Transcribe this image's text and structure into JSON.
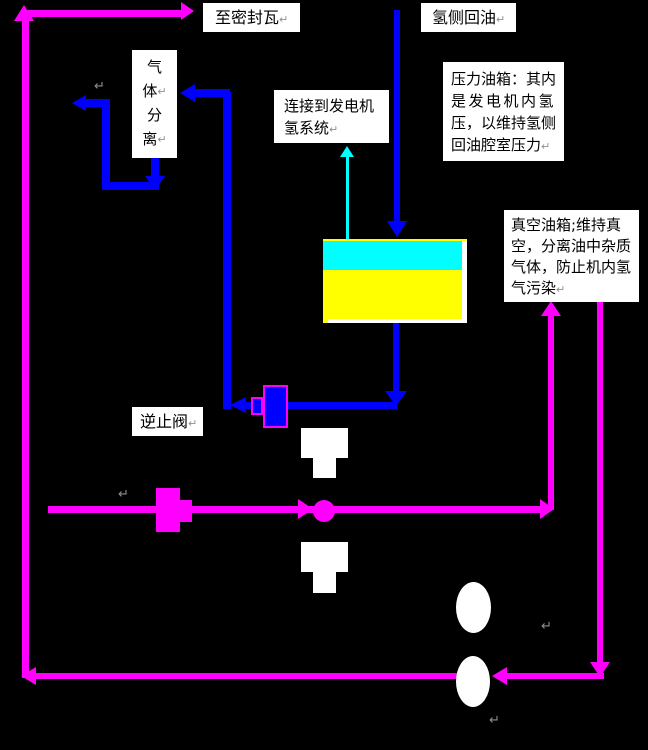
{
  "labels": {
    "to_seal_gland": "至密封瓦",
    "hydrogen_side_oil_return": "氢侧回油",
    "gas_separation": {
      "chars": [
        "气",
        "体",
        "分",
        "离"
      ]
    },
    "connect_generator": {
      "line1": "连接到发电机",
      "line2": "氢系统"
    },
    "pressure_tank_note": {
      "line1": "压力油箱：其内",
      "line2": "是发电机内氢",
      "line3": "压，以维持氢侧",
      "line4": "回油腔室压力"
    },
    "vacuum_tank_note": {
      "line1": "真空油箱;维持真",
      "line2": "空，分离油中杂质",
      "line3": "气体，防止机内氢",
      "line4": "气污染"
    },
    "check_valve": "逆止阀"
  },
  "marks": {
    "paragraph_return": "↵"
  },
  "colors": {
    "background": "#000000",
    "oil_line": "#FF00FF",
    "hydrogen_oil_line": "#0000FF",
    "gas_line": "#00FFFF",
    "tank_oil": "#FFFF00",
    "tank_gas": "#00FFFF",
    "symbol_fill": "#FFFFFF",
    "text": "#000000"
  }
}
